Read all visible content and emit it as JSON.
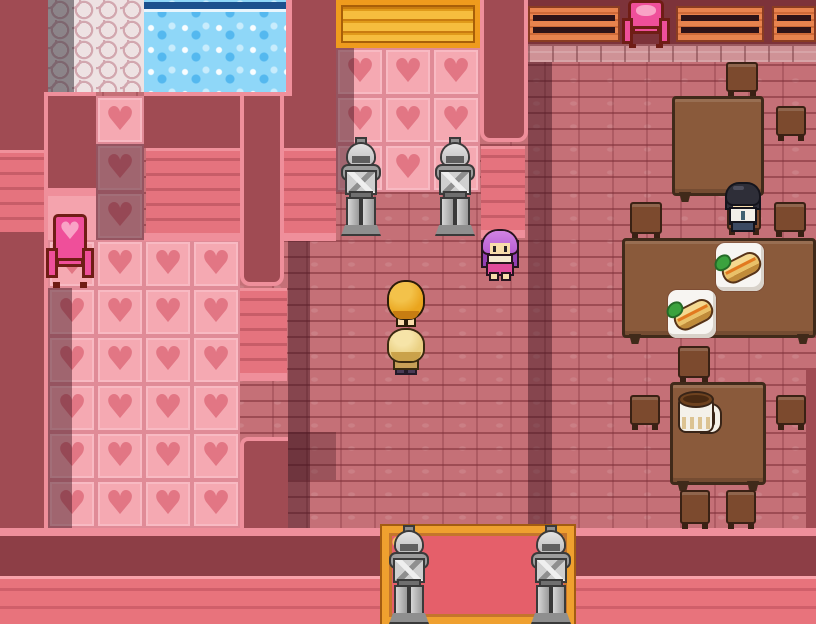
{
  "scene": {
    "description": "Top-down pixel RPG interior: heart-themed pink hall with a pool room, heart-tile chamber, gold door guarded by armor statues, and a brick dining area",
    "heart_glyph": "♥",
    "palette": {
      "wall": "#a04b53",
      "wall_dark": "#7d333a",
      "wall_face": "#e5737e",
      "wall_face_line": "#c75d68",
      "trim": "#ef8f9b",
      "brick_floor": "#c57077",
      "brick_mortar": "#7d2f38",
      "heart_tile": "#f5a9b2",
      "heart": "#e27684",
      "pool_water": "#8fd7f8",
      "pool_edge": "#1c518e",
      "cobble": "#eee2e3",
      "door_gold": "#f6bd3e",
      "door_frame": "#ef9b1d",
      "carpet": "#e55f6a",
      "carpet_border": "#efa02f",
      "table_wood": "#8a5a3b",
      "chair_wood": "#7c4a2e",
      "bench_wood": "#e8834e",
      "throne_pink": "#ef4f9a",
      "throne_frame": "#6f1d15",
      "statue_gray": "#ababab",
      "outer_band_dark": "#8d3e46",
      "outer_band_light": "#e8737c"
    },
    "tiles": {
      "heart_room": {
        "cols": 4,
        "rows": 6
      },
      "heart_corridor": {
        "cols": 1,
        "rows": 3
      },
      "door_hall": {
        "cols": 3,
        "rows": 3
      }
    },
    "characters": [
      {
        "id": "purple-hair-girl",
        "desc": "Girl with purple hair and pink skirt standing near the doorway"
      },
      {
        "id": "golden-hair-npc",
        "desc": "Character with large golden hair seen from behind"
      },
      {
        "id": "light-blonde-npc",
        "desc": "Character with light blonde hair facing away"
      },
      {
        "id": "seated-patron",
        "desc": "Black-haired patron in white shirt seated at a dining table"
      }
    ],
    "props": {
      "armor_statues": 4,
      "dining_tables": 3,
      "chairs": 10,
      "wall_benches": 3,
      "pink_thrones": 2,
      "food_plates": 2,
      "pitchers": 1,
      "gold_doors": 1,
      "red_carpets": 1,
      "pools": 1
    }
  }
}
